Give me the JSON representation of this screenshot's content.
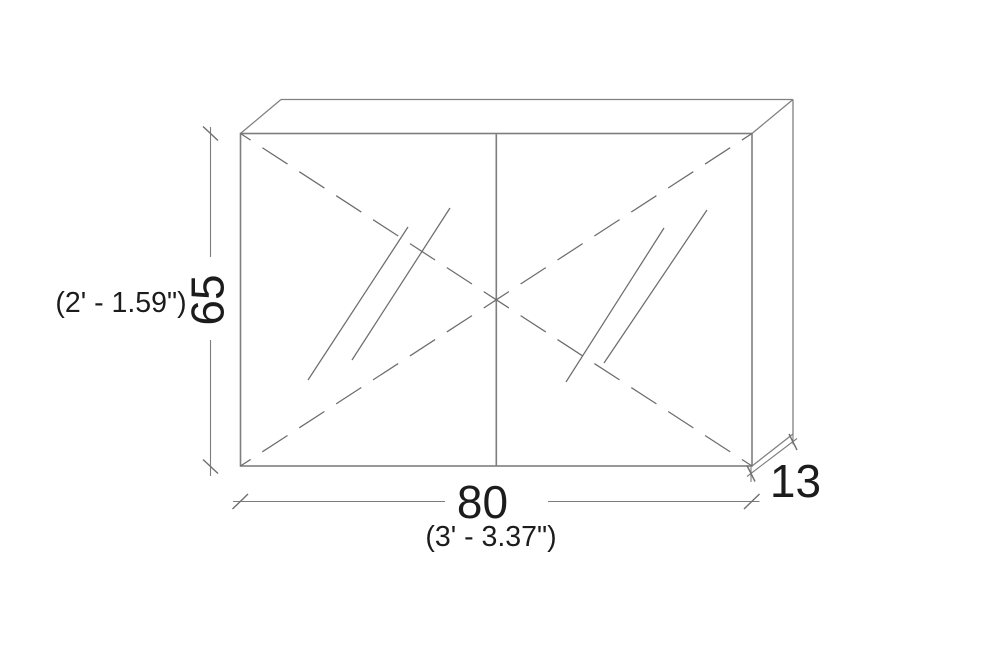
{
  "drawing": {
    "background_color": "#ffffff",
    "line_color": "#7d7d7d",
    "text_color": "#1c1c1c",
    "dimensions": {
      "height": {
        "value": "65",
        "imperial": "(2' - 1.59\")"
      },
      "width": {
        "value": "80",
        "imperial": "(3' - 3.37\")"
      },
      "depth": {
        "value": "13"
      }
    }
  }
}
